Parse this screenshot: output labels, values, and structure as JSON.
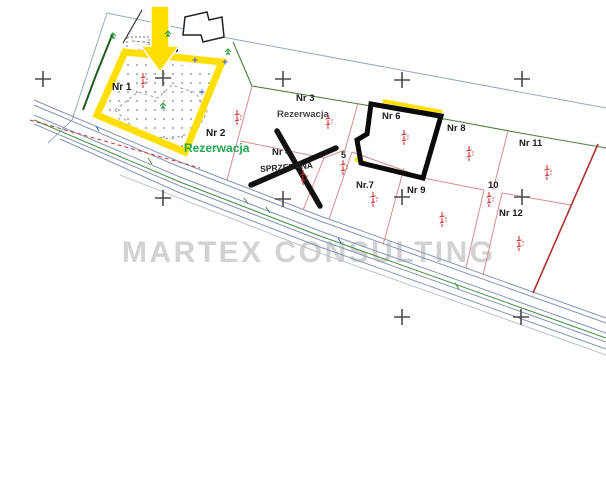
{
  "watermark": "MARTEX CONSULTING",
  "plots": [
    {
      "label": "Nr 1",
      "status": ""
    },
    {
      "label": "Nr 2",
      "status": "Rezerwacja"
    },
    {
      "label": "Nr 3",
      "status": "Rezerwacja"
    },
    {
      "label": "Nr 4",
      "status": "SPRZEDANA"
    },
    {
      "label": "5",
      "status": ""
    },
    {
      "label": "Nr 6",
      "status": ""
    },
    {
      "label": "Nr.7",
      "status": ""
    },
    {
      "label": "Nr 8",
      "status": ""
    },
    {
      "label": "Nr 9",
      "status": ""
    },
    {
      "label": "10",
      "status": ""
    },
    {
      "label": "Nr 11",
      "status": ""
    },
    {
      "label": "Nr 12",
      "status": ""
    }
  ],
  "legend": {
    "yellow_outline_plot": "Nr 1",
    "arrow_points_to": "Nr 1",
    "black_outline_plot": "Nr 6",
    "cross_marks_sold_plot": "Nr 4"
  },
  "colors": {
    "highlight_yellow": "#ffdf00",
    "outline_black": "#0a0a0a",
    "reservation_green": "#1fa84f",
    "sold_cross_black": "#111111",
    "parcel_line_pink": "#d98c8c",
    "road_line_blue": "#8694b5",
    "right_boundary_red": "#b03232",
    "survey_marker_red": "#cc2222",
    "vegetation_green": "#2f9e44",
    "watermark_gray": "#d2d2d2"
  }
}
